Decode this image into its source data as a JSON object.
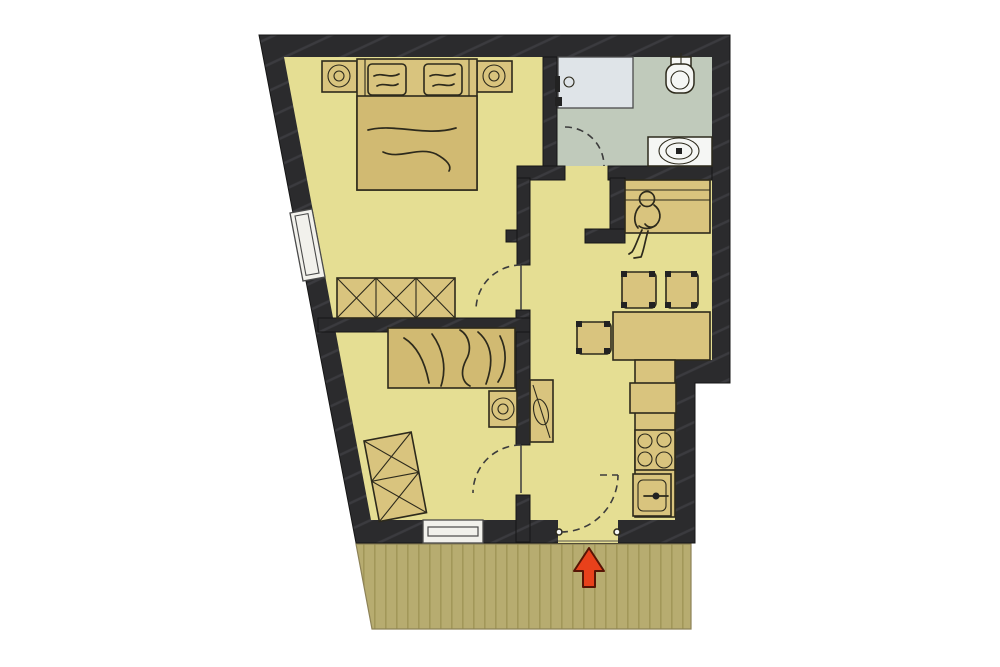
{
  "page": {
    "type": "architectural-floor-plan",
    "background": "#ffffff",
    "visible_text": ""
  },
  "colors": {
    "wall": "#2b2b2d",
    "wallHatch": "#3b3b3f",
    "outline": "#161616",
    "floor": "#e5de93",
    "bathFloor": "#c0cabb",
    "shower": "#dfe4e8",
    "fixture": "#f5f6f4",
    "furniture": "#d9c47e",
    "furnitureDark": "#d1ba72",
    "lineArt": "#2d2a1c",
    "terrace": "#b7ac70",
    "terraceStripe": "#a29759",
    "window": "#f2f1ec",
    "arrow": "#e8411b",
    "arrowOutline": "#571505",
    "doorArc": "#3c3c3c"
  },
  "rooms": [
    {
      "id": "bedroom-1",
      "position": "top-left",
      "furniture": [
        "double-bed",
        "pillow",
        "pillow",
        "nightstand-with-lamp",
        "nightstand-with-lamp",
        "wardrobe-3-sections"
      ]
    },
    {
      "id": "bathroom",
      "position": "top-right",
      "floor_color_key": "bathFloor",
      "fixtures": [
        "shower-tray",
        "toilet",
        "vanity-washbasin"
      ],
      "door": "dashed-swing-into-bathroom"
    },
    {
      "id": "living-dining-kitchen",
      "position": "right",
      "furniture": [
        "bench-with-seated-person",
        "dining-table",
        "chair",
        "chair",
        "chair",
        "tall-cabinet",
        "kitchen-counter",
        "appliance",
        "cooktop-4-burners",
        "kitchen-sink"
      ]
    },
    {
      "id": "bedroom-2",
      "position": "bottom-left",
      "furniture": [
        "single-bed",
        "nightstand-with-lamp",
        "wardrobe-2-sections"
      ]
    },
    {
      "id": "terrace",
      "position": "bottom",
      "finish": "wood-decking-stripes"
    }
  ],
  "openings": {
    "windows": 2,
    "interior_doors": 3,
    "entrance_doors": 1
  },
  "entrance": {
    "marker": "red-arrow",
    "direction": "up-into-apartment"
  }
}
